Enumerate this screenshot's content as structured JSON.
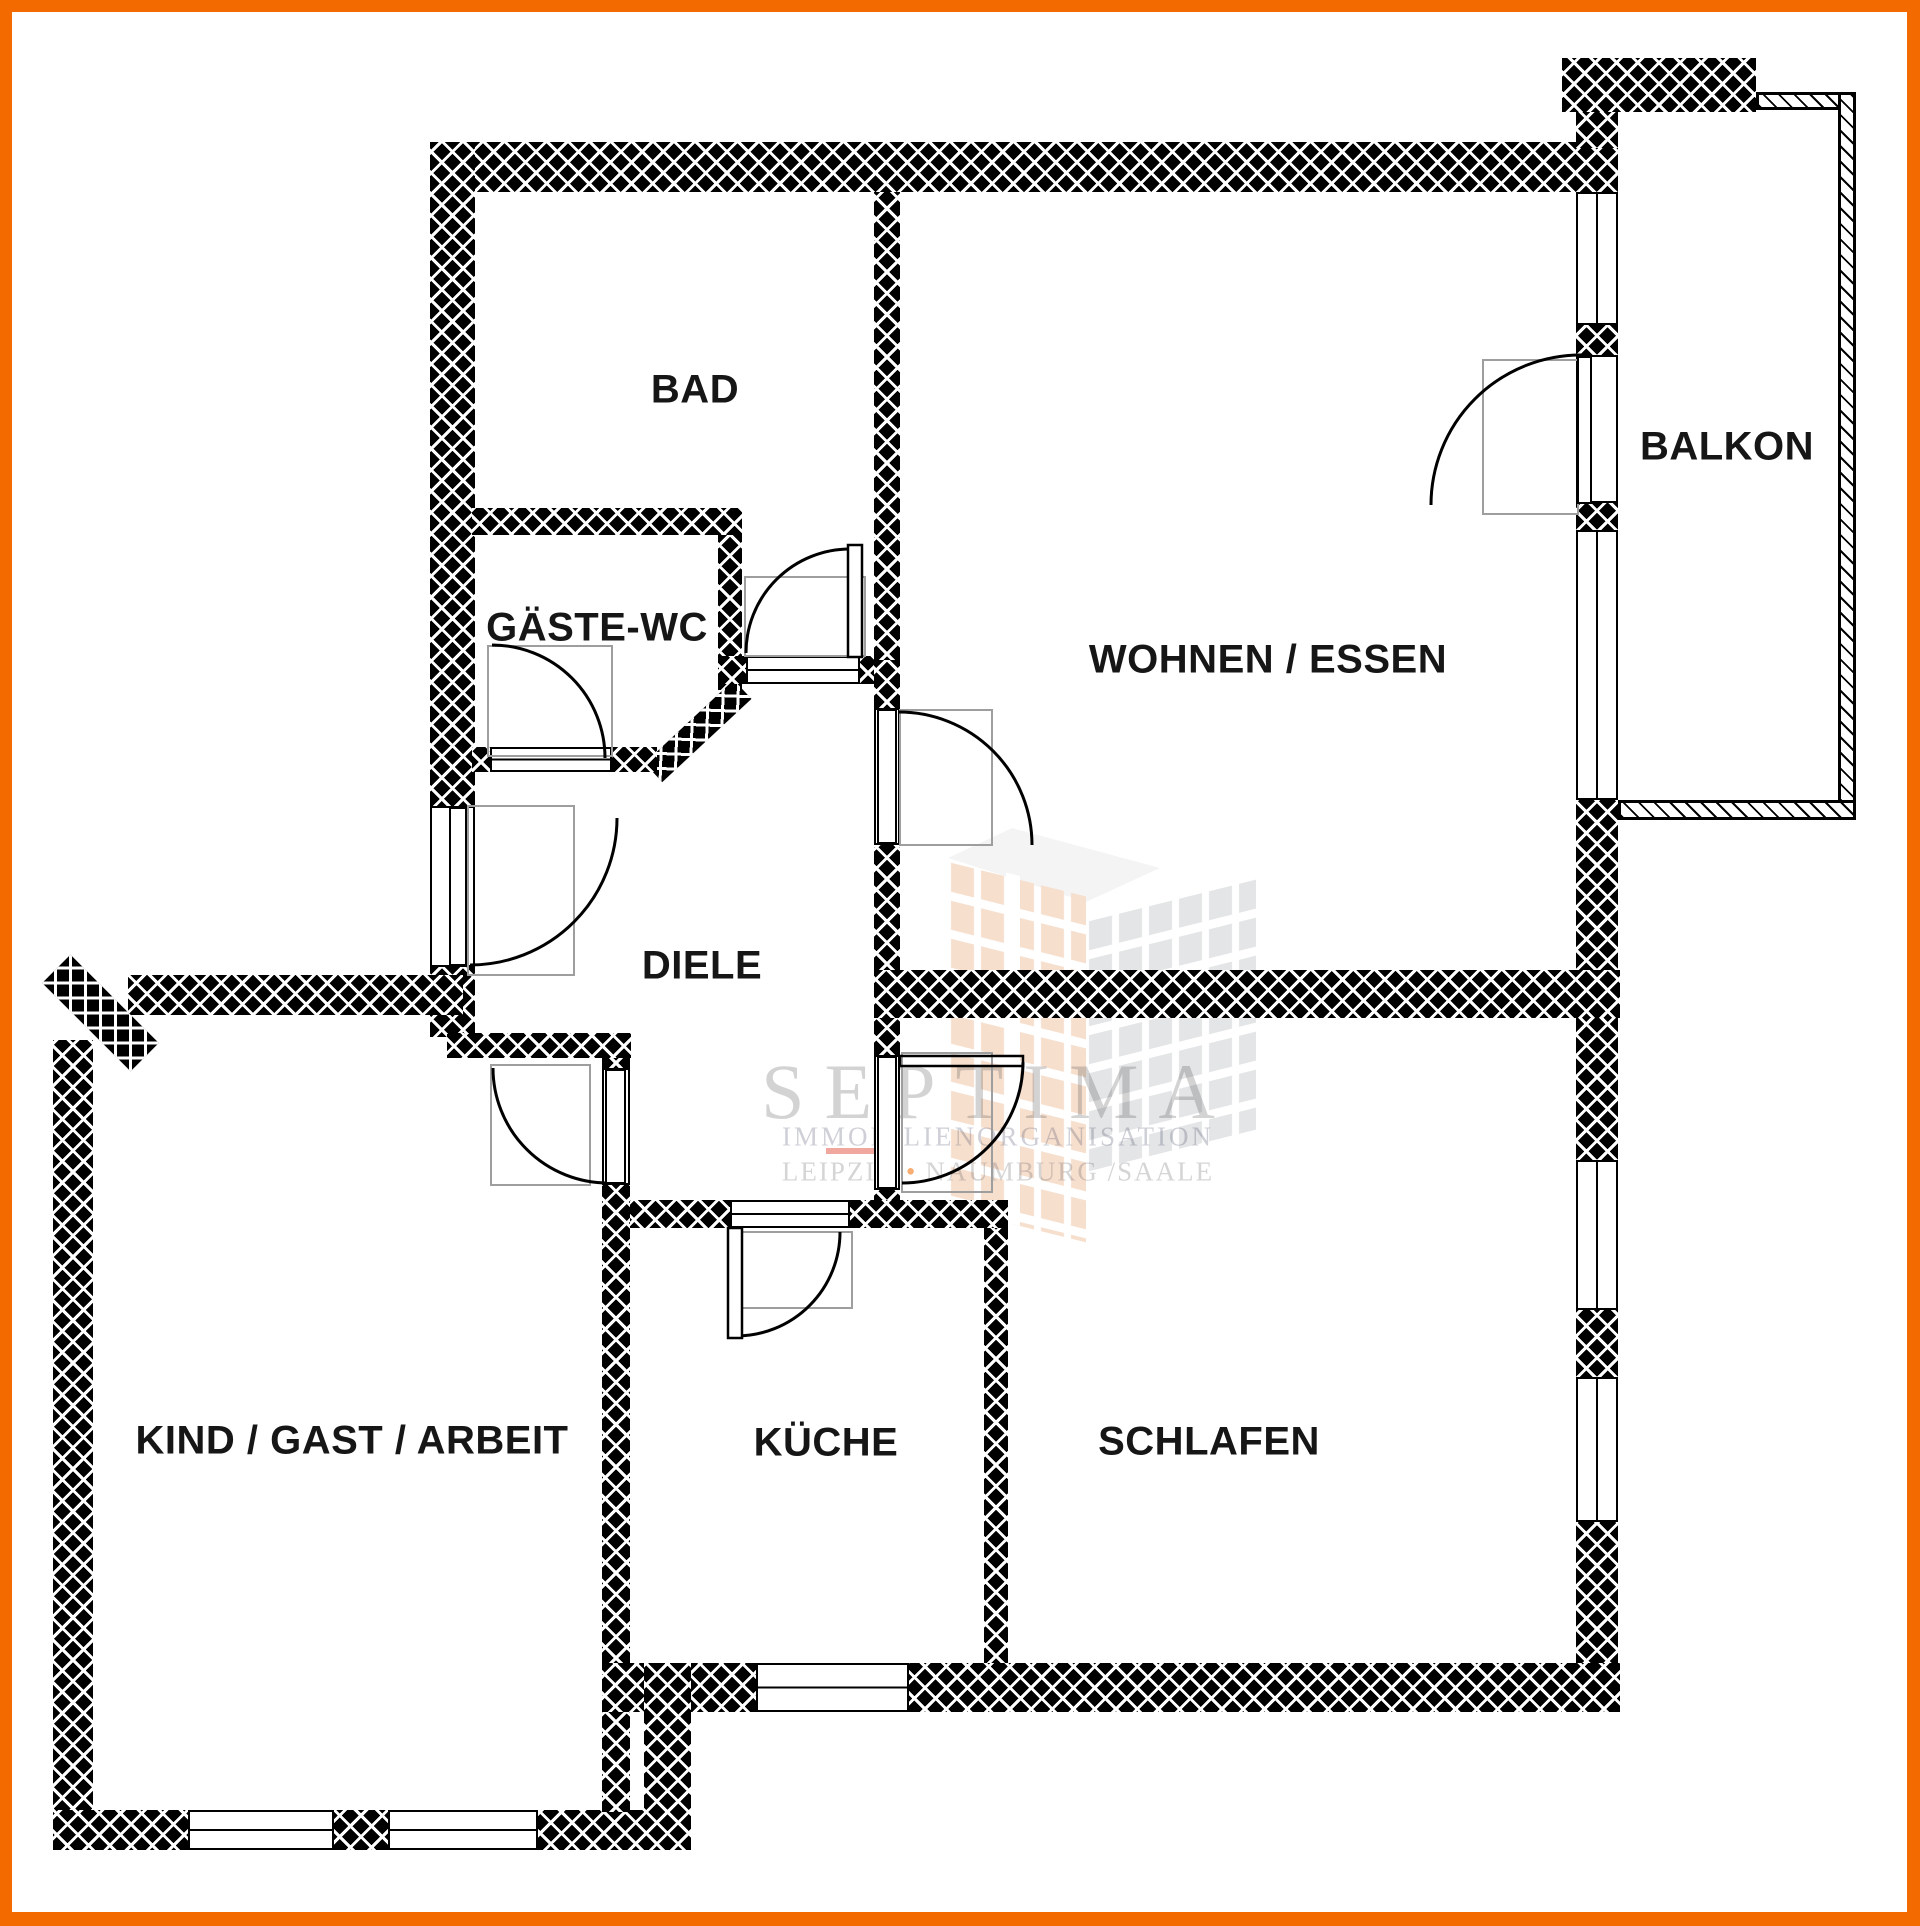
{
  "rooms": {
    "bad": {
      "label": "BAD"
    },
    "gaeste_wc": {
      "label": "GÄSTE-WC"
    },
    "diele": {
      "label": "DIELE"
    },
    "wohnen_essen": {
      "label": "WOHNEN / ESSEN"
    },
    "balkon": {
      "label": "BALKON"
    },
    "kind_gast_arbeit": {
      "label": "KIND / GAST / ARBEIT"
    },
    "kueche": {
      "label": "KÜCHE"
    },
    "schlafen": {
      "label": "SCHLAFEN"
    }
  },
  "watermark": {
    "brand": "SEPTIMA",
    "line2": "IMMOBILIENORGANISATION",
    "city_left": "LEIPZIG",
    "separator": "•",
    "city_right": "NAUMBURG /SAALE"
  },
  "colors": {
    "frame_border": "#F26A00",
    "wall": "#000000",
    "hatch_line": "#FFFFFF",
    "door_arc": "#000000",
    "swing_box": "#9E9E9E",
    "watermark_text": "#C6C6C6",
    "watermark_orange": "#E38A4D"
  }
}
